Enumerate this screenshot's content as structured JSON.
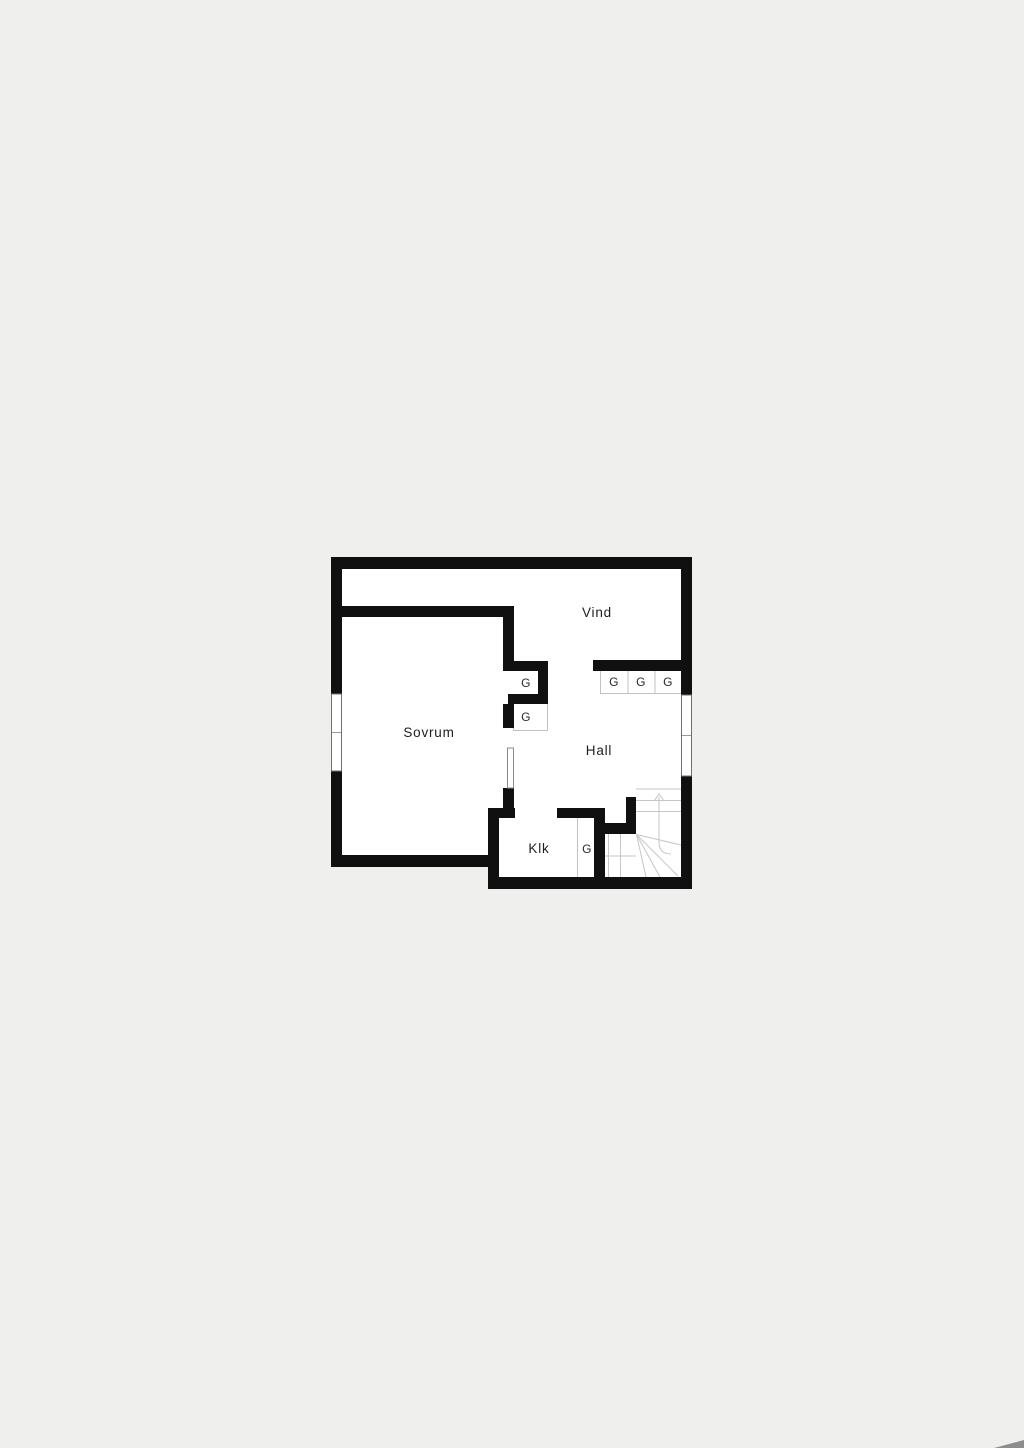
{
  "plan": {
    "rooms": {
      "vind": "Vind",
      "sovrum": "Sovrum",
      "hall": "Hall",
      "klk": "Klk"
    },
    "closets": {
      "g1": "G",
      "g2": "G",
      "g3": "G",
      "g4": "G",
      "g5": "G",
      "g6": "G"
    },
    "colors": {
      "background": "#efefee",
      "wall": "#101010",
      "floor": "#ffffff",
      "thin_line": "#c2c2c2",
      "text": "#1e1e1e"
    },
    "stairs": {
      "direction_arrow": "up"
    }
  }
}
